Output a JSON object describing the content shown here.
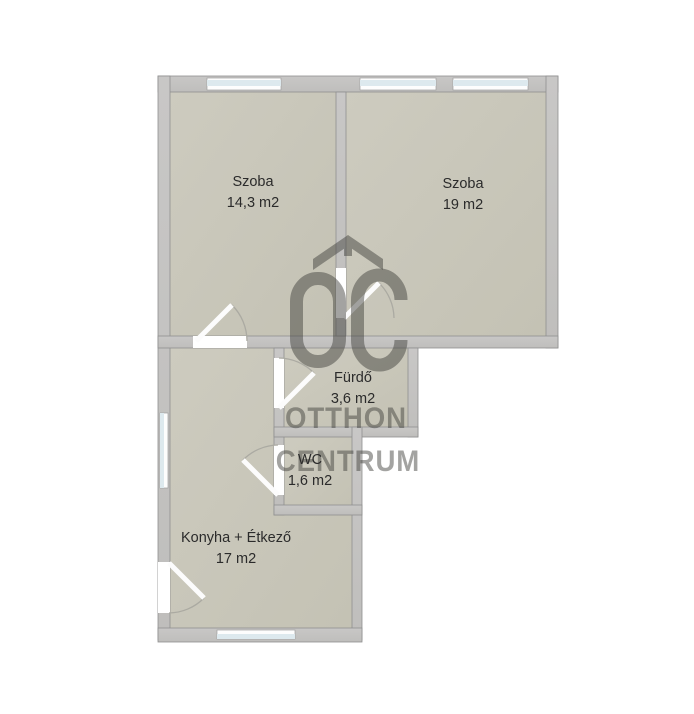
{
  "floorplan": {
    "rooms": [
      {
        "name": "Szoba",
        "area": "14,3 m2"
      },
      {
        "name": "Szoba",
        "area": "19 m2"
      },
      {
        "name": "Fürdő",
        "area": "3,6 m2"
      },
      {
        "name": "WC",
        "area": "1,6 m2"
      },
      {
        "name": "Konyha + Étkező",
        "area": "17 m2"
      }
    ],
    "watermark": {
      "logo": "oc-roof-logo",
      "brand_line1": "OTTHON",
      "brand_line2": "CENTRUM"
    },
    "colors": {
      "wall": "#c4c3c1",
      "wall_outline": "#8f8f8f",
      "floor": "#c9c7ba",
      "window_glass": "#dde9ee",
      "door_leaf": "#ffffff",
      "label_text": "#2b2b2b",
      "watermark_gray": "#3e3e3a"
    }
  }
}
